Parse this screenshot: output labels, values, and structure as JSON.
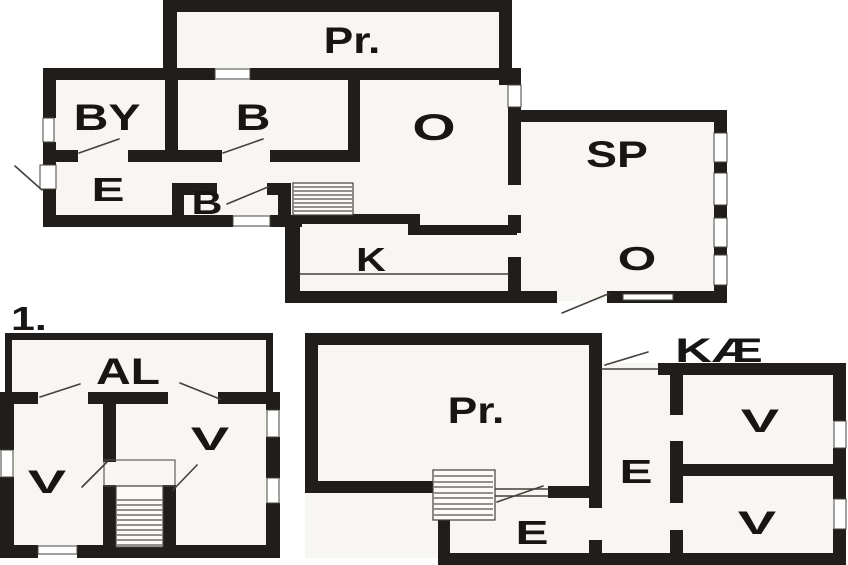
{
  "document": {
    "kind_note": "black-and-white scanned floor plan drawing with three plans"
  },
  "colors": {
    "wall": "#201d1a",
    "floor": "#f7f6f2",
    "background": "#ffffff",
    "thin_line": "#44403a",
    "text": "#181614"
  },
  "floors": {
    "ground": {
      "rooms": {
        "pr": "Pr.",
        "by": "BY",
        "b": "B",
        "o": "O",
        "e": "E",
        "b_small": "B",
        "k": "K",
        "sp": "SP",
        "o_small": "O"
      }
    },
    "first": {
      "floor_label": "1.",
      "rooms": {
        "al": "AL",
        "v_left": "V",
        "v_right": "V"
      }
    },
    "basement": {
      "entrance_label": "KÆ",
      "rooms": {
        "pr": "Pr.",
        "e_upper": "E",
        "e_lower": "E",
        "v_upper": "V",
        "v_lower": "V"
      }
    }
  }
}
